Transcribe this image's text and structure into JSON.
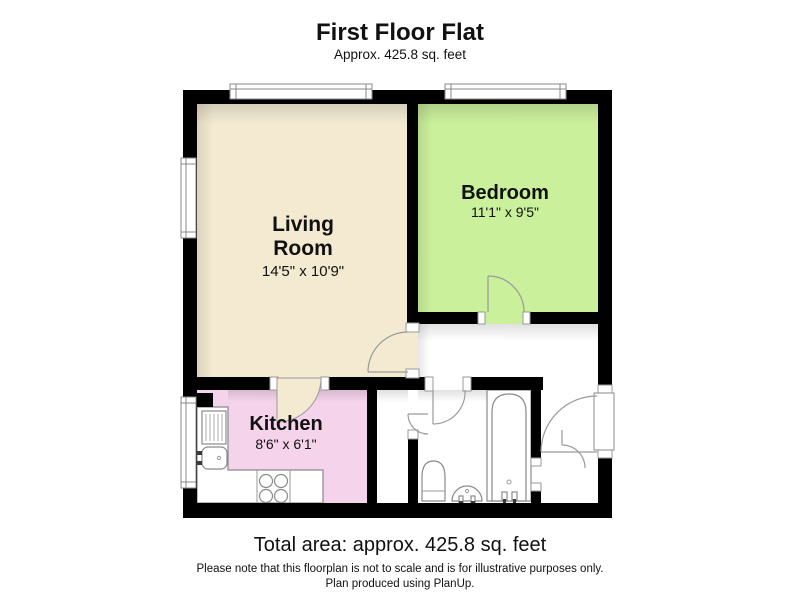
{
  "header": {
    "title": "First Floor Flat",
    "subtitle": "Approx. 425.8 sq. feet"
  },
  "rooms": {
    "living": {
      "name_line1": "Living",
      "name_line2": "Room",
      "dims": "14'5\" x 10'9\"",
      "color": "#F3EAD1"
    },
    "bedroom": {
      "name": "Bedroom",
      "dims": "11'1\" x 9'5\"",
      "color": "#CBF09C"
    },
    "kitchen": {
      "name": "Kitchen",
      "dims": "8'6\" x 6'1\"",
      "color": "#F5D3EB"
    }
  },
  "footer": {
    "total_area": "Total area: approx. 425.8 sq. feet",
    "disclaimer": "Please note that this floorplan is not to scale and is for illustrative purposes only.",
    "credit": "Plan produced using PlanUp."
  }
}
